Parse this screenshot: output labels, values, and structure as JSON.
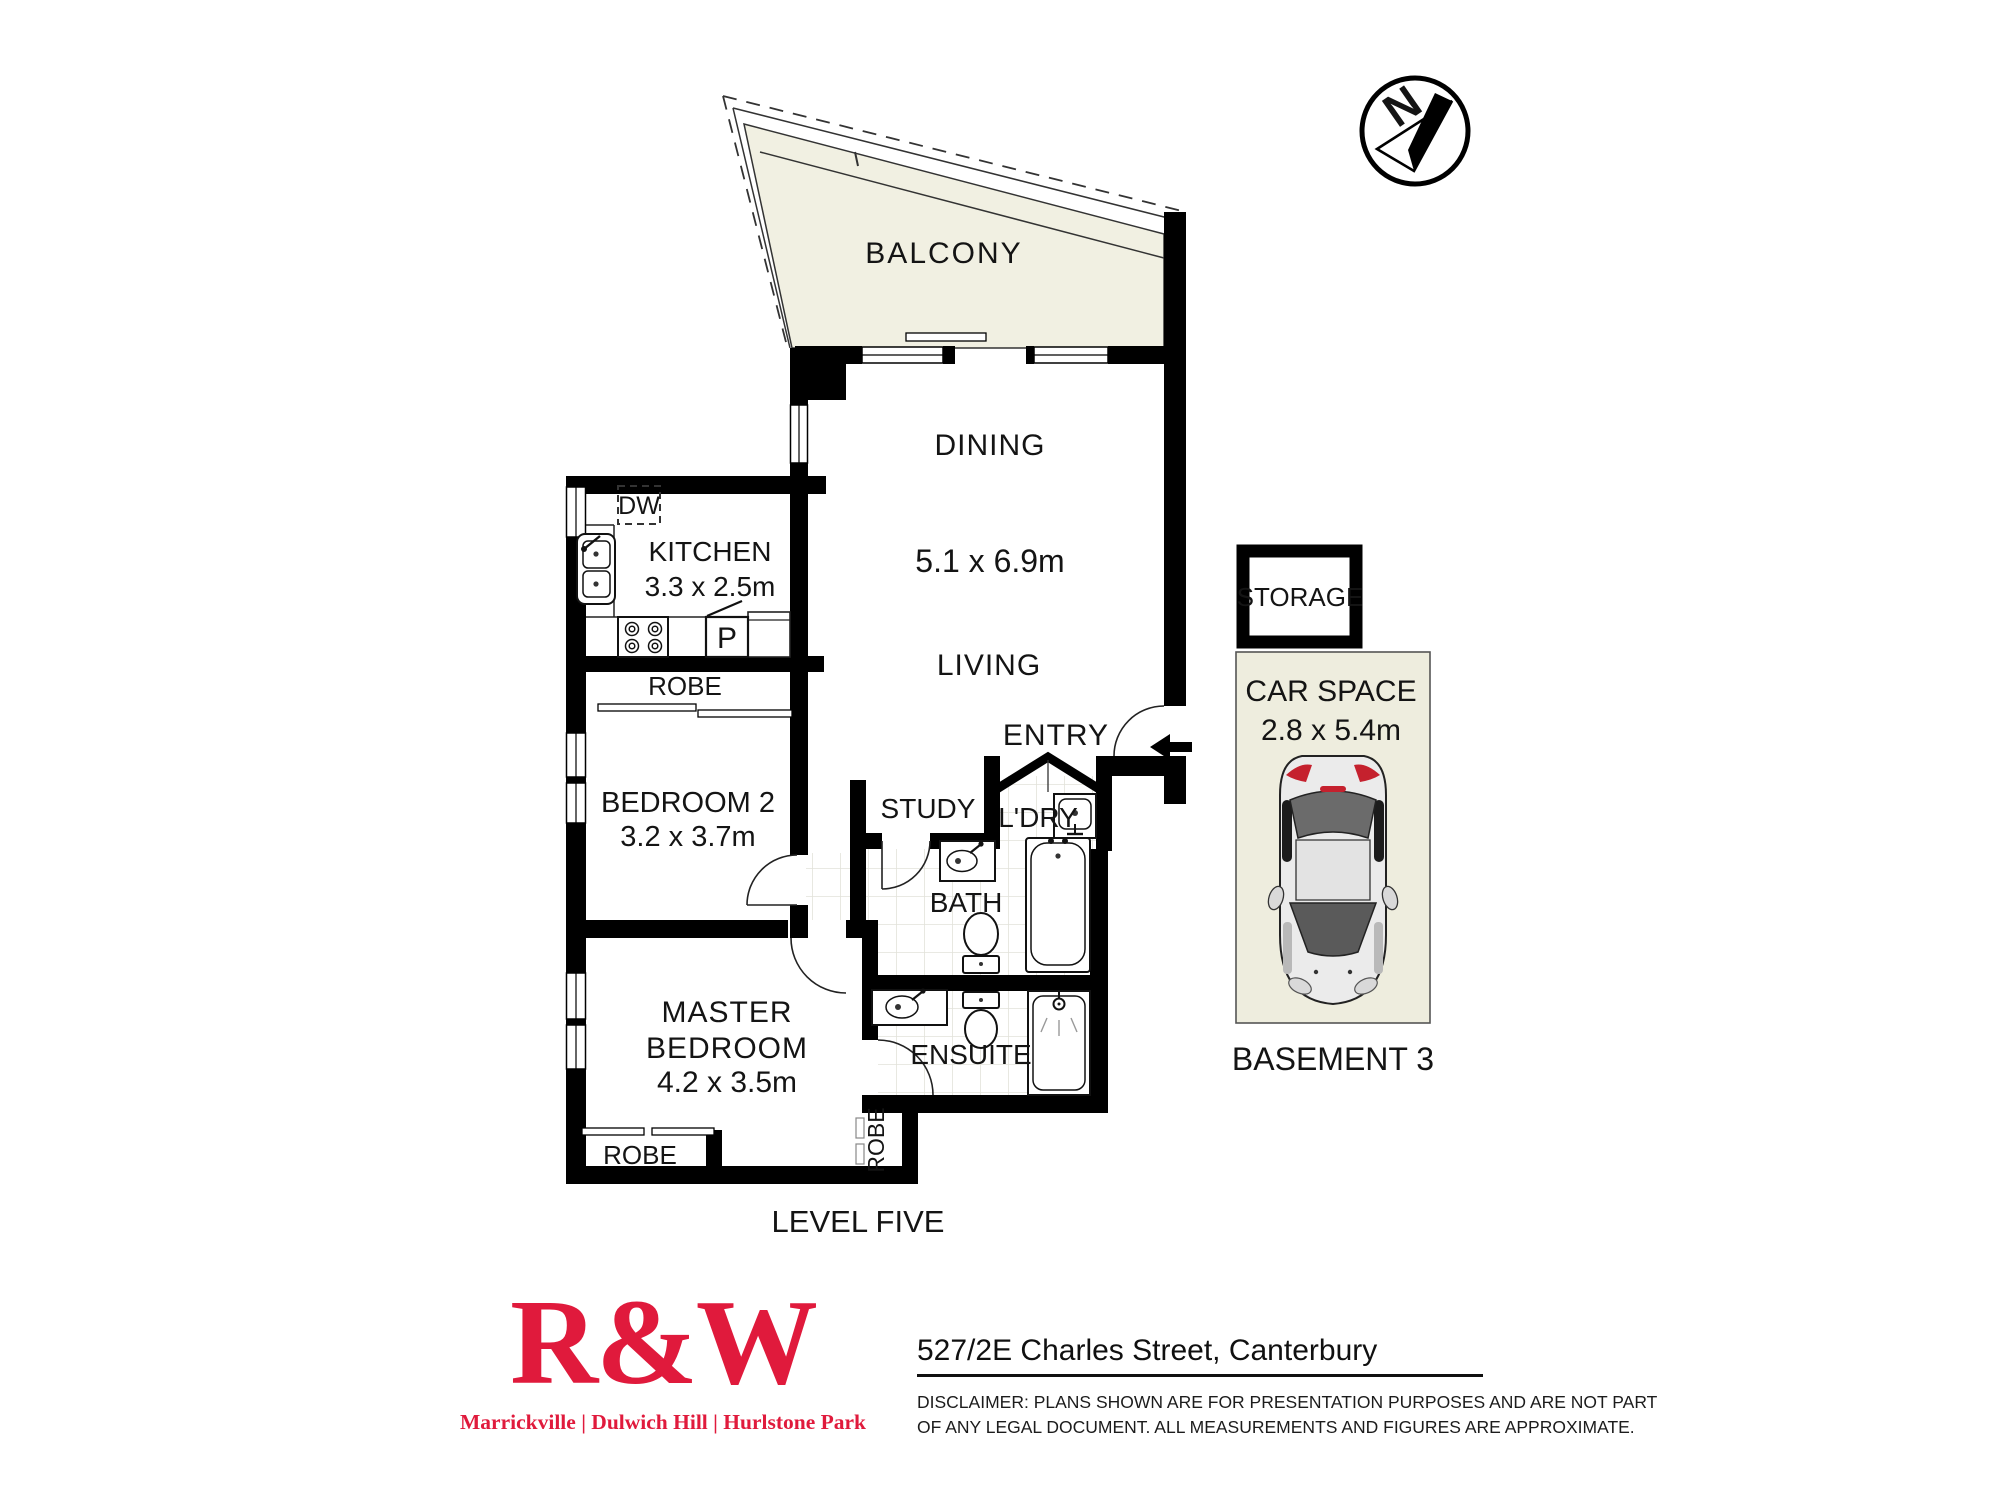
{
  "plan": {
    "balcony": "BALCONY",
    "dining": "DINING",
    "living_dims": "5.1 x 6.9m",
    "living": "LIVING",
    "entry": "ENTRY",
    "kitchen": "KITCHEN",
    "kitchen_dims": "3.3 x 2.5m",
    "dw": "DW",
    "pantry": "P",
    "robe_bed2": "ROBE",
    "bedroom2": "BEDROOM 2",
    "bedroom2_dims": "3.2 x 3.7m",
    "study": "STUDY",
    "laundry": "L'DRY",
    "bath": "BATH",
    "ensuite": "ENSUITE",
    "master_line1": "MASTER",
    "master_line2": "BEDROOM",
    "master_dims": "4.2 x 3.5m",
    "robe_master": "ROBE",
    "robe_side": "ROBE",
    "storage": "STORAGE",
    "car_space": "CAR SPACE",
    "car_space_dims": "2.8 x 5.4m",
    "basement": "BASEMENT 3",
    "level": "LEVEL FIVE",
    "compass_n": "N"
  },
  "footer": {
    "logo": "R&W",
    "offices": "Marrickville | Dulwich Hill | Hurlstone Park",
    "address": "527/2E Charles Street, Canterbury",
    "disclaimer_line1": "DISCLAIMER:  PLANS SHOWN ARE FOR PRESENTATION PURPOSES AND ARE NOT PART",
    "disclaimer_line2": "OF ANY LEGAL DOCUMENT. ALL MEASUREMENTS AND FIGURES ARE APPROXIMATE."
  },
  "colors": {
    "brand_red": "#e01a3c",
    "wall_black": "#000000",
    "balcony_fill": "#f1f0e2",
    "carspace_fill": "#eeedde",
    "tile_line": "#e2e2da",
    "car_glass": "#5a5a5a",
    "car_taillight": "#c5212e"
  }
}
